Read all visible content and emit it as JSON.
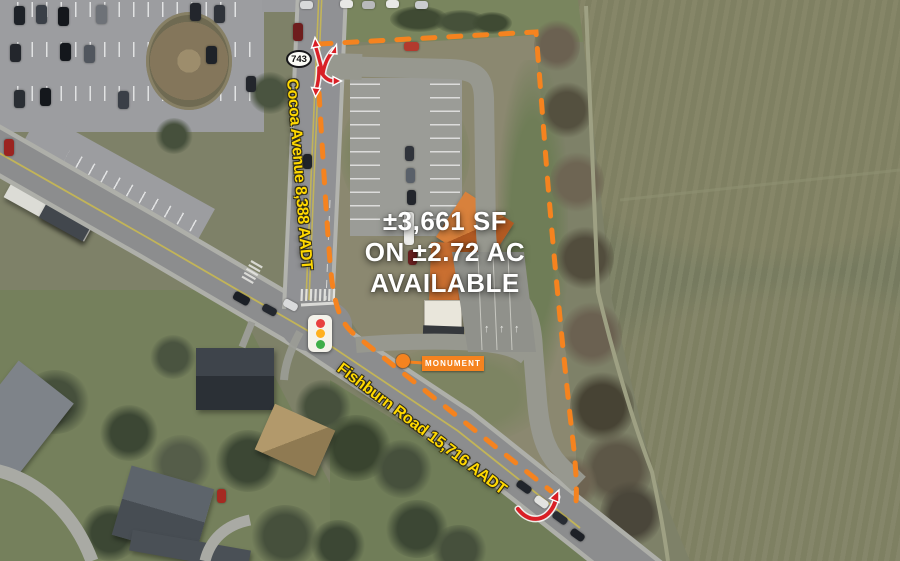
{
  "map": {
    "headline": {
      "line1": "±3,661 SF",
      "line2": "ON ±2.72 AC",
      "line3": "AVAILABLE"
    },
    "roads": {
      "route_shield": "743",
      "cocoa": {
        "label": "Cocoa Avenue 8,388 AADT"
      },
      "fishburn": {
        "label": "Fishburn Road 15,716 AADT"
      }
    },
    "monument": {
      "label": "MONUMENT"
    },
    "colors": {
      "boundary_orange": "#F5831F",
      "label_yellow": "#FFD800",
      "arrow_red": "#D91F26",
      "building_highlight": "#C96F31",
      "field_green": "#7B8063"
    }
  }
}
